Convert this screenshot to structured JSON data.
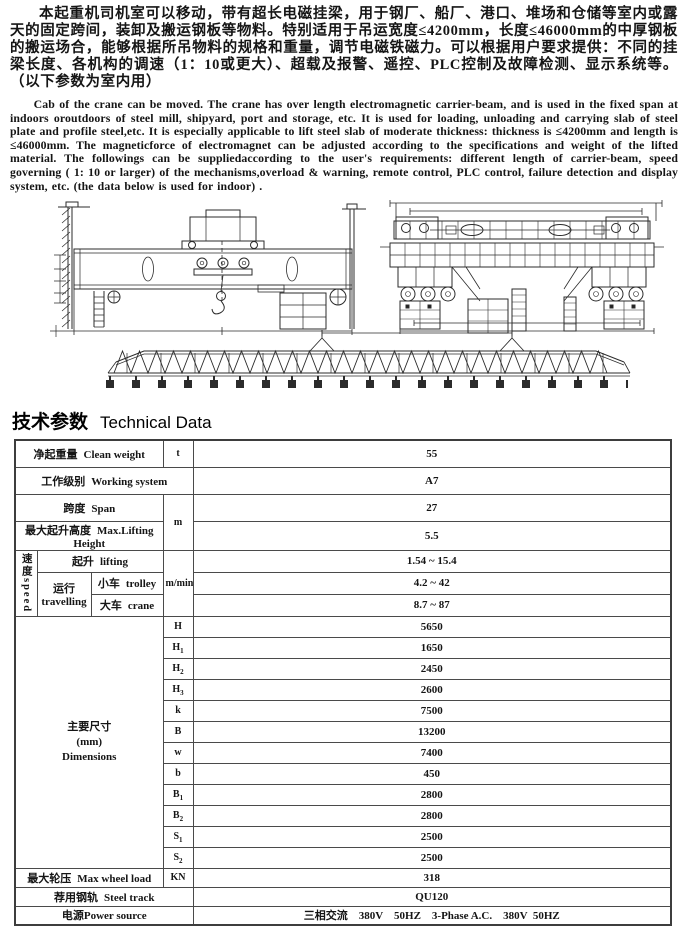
{
  "page": {
    "intro_zh": "本起重机司机室可以移动，带有超长电磁挂梁，用于钢厂、船厂、港口、堆场和仓储等室内或露天的固定跨间，装卸及搬运钢板等物料。特别适用于吊运宽度≤4200mm，长度≤46000mm的中厚钢板的搬运场合，能够根据所吊物料的规格和重量，调节电磁铁磁力。可以根据用户要求提供：不同的挂梁长度、各机构的调速（1：10或更大）、超载及报警、遥控、PLC控制及故障检测、显示系统等。（以下参数为室内用）",
    "intro_en": "Cab of the crane can be moved. The crane has over length electromagnetic carrier-beam, and is used in the fixed span at indoors oroutdoors of steel mill, shipyard, port and storage, etc. It is used for loading, unloading and carrying slab of steel plate and profile steel,etc. It is especially applicable to lift steel slab of moderate thickness: thickness is ≤4200mm and length is ≤46000mm. The magneticforce of electromagnet can be adjusted according to the specifications and weight of the lifted material. The followings can be suppliedaccording to the user's requirements: different length of carrier-beam, speed governing ( 1: 10 or larger) of the mechanisms,overload & warning, remote control, PLC control, failure detection and display system, etc. (the data below is used for indoor) ."
  },
  "heading": {
    "zh": "技术参数",
    "en": "Technical Data"
  },
  "table": {
    "clean_weight": {
      "label_zh": "净起重量",
      "label_en": "Clean weight",
      "unit": "t",
      "value": "55"
    },
    "working_system": {
      "label_zh": "工作级别",
      "label_en": "Working system",
      "value": "A7"
    },
    "span": {
      "label_zh": "跨度",
      "label_en": "Span",
      "unit": "m",
      "value": "27"
    },
    "max_lifting_height": {
      "label_zh": "最大起升高度",
      "label_en": "Max.Lifting Height",
      "value": "5.5"
    },
    "speed": {
      "group_zh": "速度",
      "group_en": "speed",
      "unit": "m/min",
      "lifting": {
        "label_zh": "起升",
        "label_en": "lifting",
        "value": "1.54 ~ 15.4"
      },
      "travelling": {
        "label_zh": "运行",
        "label_en": "travelling"
      },
      "trolley": {
        "label_zh": "小车",
        "label_en": "trolley",
        "value": "4.2 ~ 42"
      },
      "crane": {
        "label_zh": "大车",
        "label_en": "crane",
        "value": "8.7 ~ 87"
      }
    },
    "dimensions": {
      "label_zh": "主要尺寸",
      "label_note": "(mm)",
      "label_en": "Dimensions",
      "rows": [
        {
          "sym": "H",
          "sub": "",
          "value": "5650"
        },
        {
          "sym": "H",
          "sub": "1",
          "value": "1650"
        },
        {
          "sym": "H",
          "sub": "2",
          "value": "2450"
        },
        {
          "sym": "H",
          "sub": "3",
          "value": "2600"
        },
        {
          "sym": "k",
          "sub": "",
          "value": "7500"
        },
        {
          "sym": "B",
          "sub": "",
          "value": "13200"
        },
        {
          "sym": "w",
          "sub": "",
          "value": "7400"
        },
        {
          "sym": "b",
          "sub": "",
          "value": "450"
        },
        {
          "sym": "B",
          "sub": "1",
          "value": "2800"
        },
        {
          "sym": "B",
          "sub": "2",
          "value": "2800"
        },
        {
          "sym": "S",
          "sub": "1",
          "value": "2500"
        },
        {
          "sym": "S",
          "sub": "2",
          "value": "2500"
        }
      ]
    },
    "max_wheel_load": {
      "label_zh": "最大轮压",
      "label_en": "Max wheel load",
      "unit": "KN",
      "value": "318"
    },
    "steel_track": {
      "label_zh": "荐用钢轨",
      "label_en": "Steel track",
      "value": "QU120"
    },
    "power_source": {
      "label_zh": "电源",
      "label_en": "Power source",
      "value": "三相交流    380V    50HZ    3-Phase A.C.    380V  50HZ"
    }
  }
}
